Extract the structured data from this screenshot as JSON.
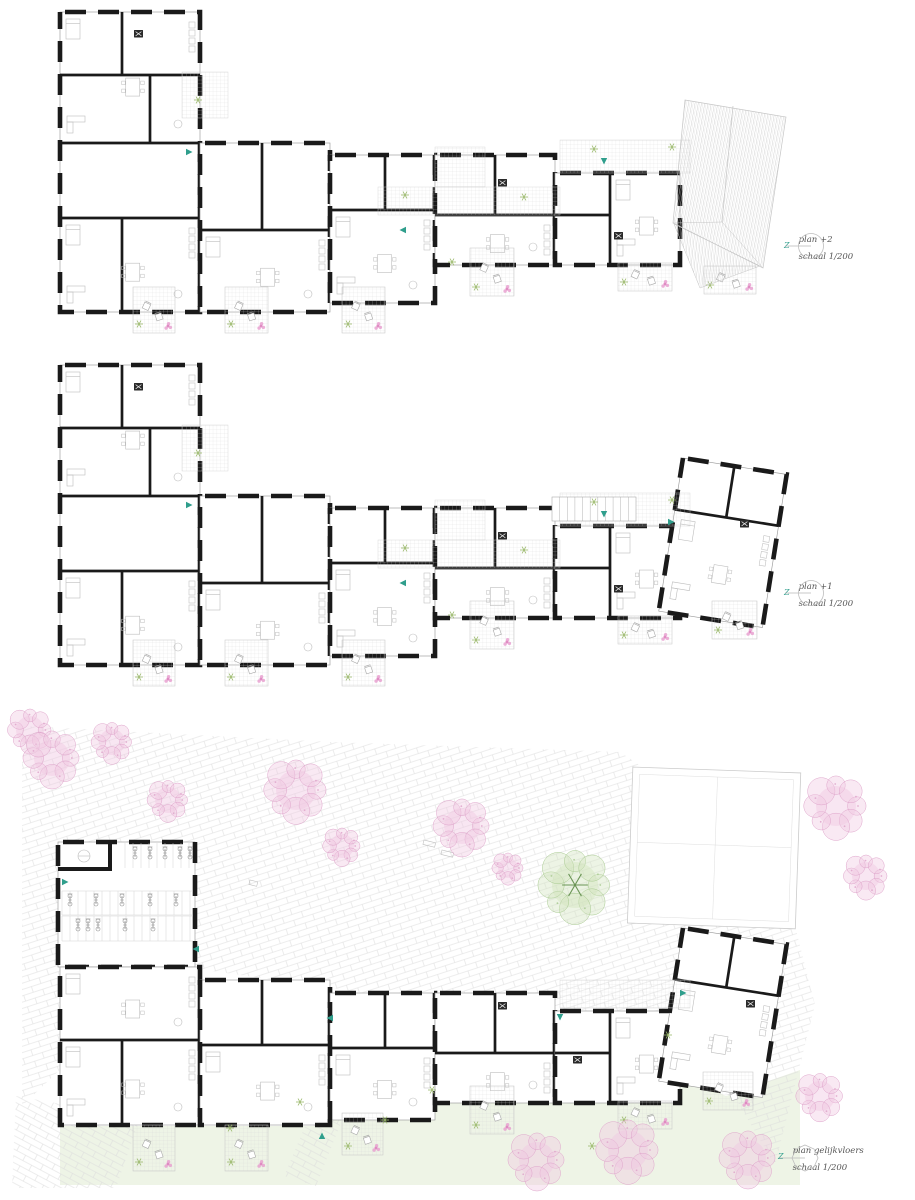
{
  "sheet": {
    "background": "#ffffff"
  },
  "palette": {
    "wall": "#1a1a1a",
    "furniture": "#bdbdbd",
    "hatch_line": "#d6d6d6",
    "paving_line": "#dcdcdc",
    "lawn": "#eef4e6",
    "tree_pink": "#f0c8e2",
    "tree_pink_edge": "#dfa4cb",
    "tree_green": "#d2e4bf",
    "tree_green_edge": "#a8ca90",
    "accent_teal": "#2f9e8c",
    "plant_green": "#9cba6d",
    "flower_pink": "#e79cce",
    "roof_line": "#c6c6c6",
    "label_text": "#555555",
    "compass_ring": "#b9b9b9"
  },
  "plans": [
    {
      "name": "plan +2",
      "scale_label": "schaal 1/200",
      "compass_letter": "Z"
    },
    {
      "name": "plan +1",
      "scale_label": "schaal 1/200",
      "compass_letter": "Z"
    },
    {
      "name": "plan gelijkvloers",
      "scale_label": "schaal 1/200",
      "compass_letter": "Z"
    }
  ]
}
